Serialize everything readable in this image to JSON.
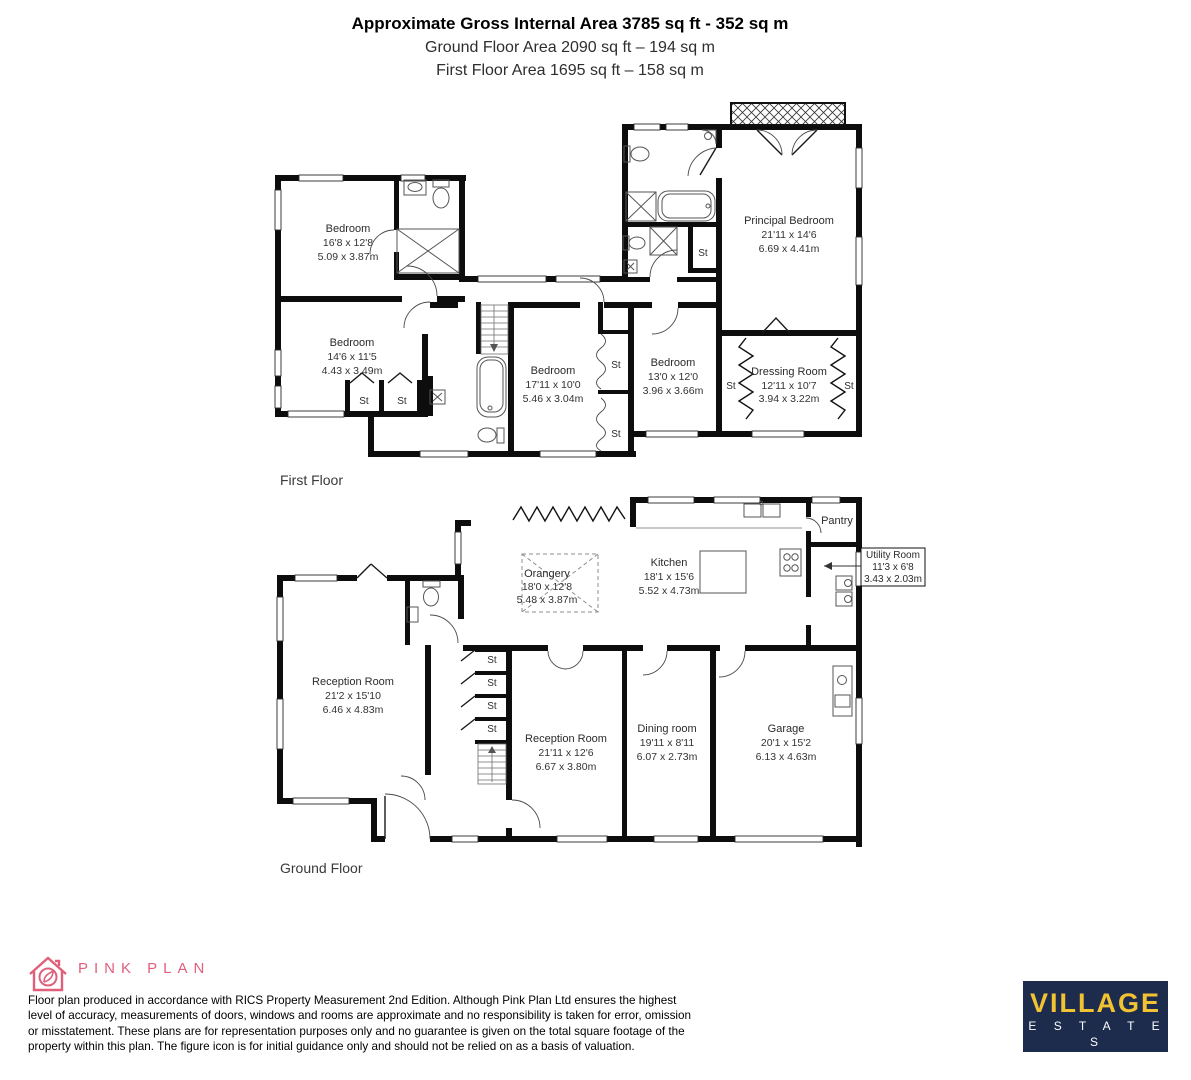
{
  "header": {
    "title": "Approximate Gross Internal Area 3785 sq ft - 352 sq m",
    "subtitle1": "Ground Floor Area 2090 sq ft – 194 sq m",
    "subtitle2": "First Floor Area 1695 sq ft – 158 sq m"
  },
  "floors": {
    "first": {
      "label": "First Floor",
      "rooms": {
        "bedroom1": {
          "name": "Bedroom",
          "ft": "16'8 x 12'8",
          "m": "5.09 x 3.87m"
        },
        "bedroom2": {
          "name": "Bedroom",
          "ft": "14'6 x 11'5",
          "m": "4.43 x 3.49m"
        },
        "bedroom3": {
          "name": "Bedroom",
          "ft": "17'11 x 10'0",
          "m": "5.46 x 3.04m"
        },
        "bedroom4": {
          "name": "Bedroom",
          "ft": "13'0 x 12'0",
          "m": "3.96 x 3.66m"
        },
        "principal": {
          "name": "Principal Bedroom",
          "ft": "21'11 x 14'6",
          "m": "6.69 x 4.41m"
        },
        "dressing": {
          "name": "Dressing Room",
          "ft": "12'11 x 10'7",
          "m": "3.94 x 3.22m"
        }
      }
    },
    "ground": {
      "label": "Ground Floor",
      "rooms": {
        "orangery": {
          "name": "Orangery",
          "ft": "18'0 x 12'8",
          "m": "5.48 x 3.87m"
        },
        "kitchen": {
          "name": "Kitchen",
          "ft": "18'1 x 15'6",
          "m": "5.52 x 4.73m"
        },
        "pantry": {
          "name": "Pantry"
        },
        "utility": {
          "name": "Utility Room",
          "ft": "11'3 x 6'8",
          "m": "3.43 x 2.03m"
        },
        "reception1": {
          "name": "Reception Room",
          "ft": "21'2 x 15'10",
          "m": "6.46 x 4.83m"
        },
        "reception2": {
          "name": "Reception Room",
          "ft": "21'11 x 12'6",
          "m": "6.67 x 3.80m"
        },
        "dining": {
          "name": "Dining room",
          "ft": "19'11 x 8'11",
          "m": "6.07 x 2.73m"
        },
        "garage": {
          "name": "Garage",
          "ft": "20'1 x 15'2",
          "m": "6.13 x 4.63m"
        }
      }
    }
  },
  "labels": {
    "st": "St"
  },
  "footer": {
    "logo_text": "PINK PLAN",
    "disclaimer": "Floor plan produced in accordance with RICS Property Measurement 2nd Edition. Although Pink Plan Ltd ensures the highest level of accuracy, measurements of doors, windows and rooms are approximate and no responsibility is taken for error, omission or misstatement. These plans are for representation purposes only and no guarantee is given on the total square footage of the property within this plan. The figure icon is for initial guidance only and should not be relied on as a basis of valuation.",
    "brand": {
      "line1": "VILLAGE",
      "line2": "E S T A T E S"
    }
  },
  "colors": {
    "pink": "#e0607c",
    "navy": "#1d2b4d",
    "yellow": "#f1c232",
    "wall": "#0d0d0d"
  }
}
